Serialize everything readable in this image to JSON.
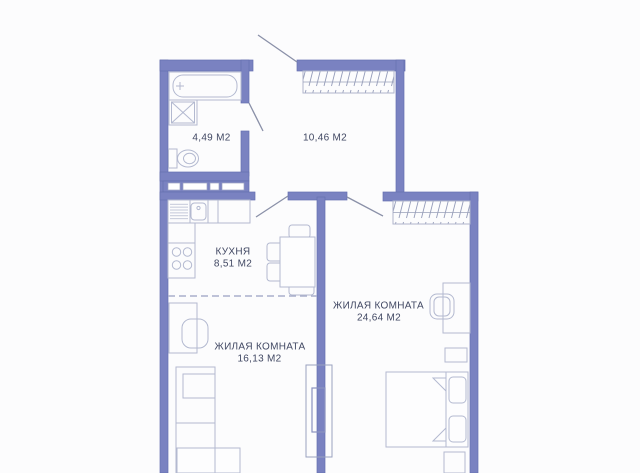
{
  "floor_plan": {
    "colors": {
      "wall": "#7A82C1",
      "wall_edge": "#6670AF",
      "furniture_outline": "#B3B9D0",
      "hatch": "#959CB9",
      "text": "#414863",
      "dashed_divider": "#A9AFCB",
      "background": "#FCFCFD"
    },
    "rooms": [
      {
        "id": "bathroom",
        "name_label": "",
        "area_label": "4,49 М2"
      },
      {
        "id": "hallway",
        "name_label": "",
        "area_label": "10,46 М2"
      },
      {
        "id": "kitchen",
        "name_label": "КУХНЯ",
        "area_label": "8,51 М2"
      },
      {
        "id": "living_room_1",
        "name_label": "ЖИЛАЯ КОМНАТА",
        "area_label": "16,13 М2"
      },
      {
        "id": "living_room_2",
        "name_label": "ЖИЛАЯ КОМНАТА",
        "area_label": "24,64 М2"
      }
    ]
  }
}
